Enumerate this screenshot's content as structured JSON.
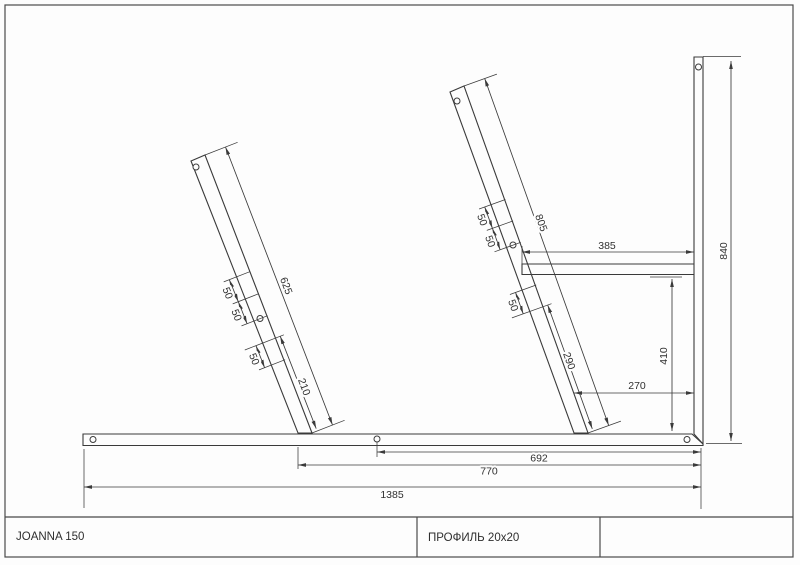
{
  "page": {
    "background": "#fdfdfd",
    "line_color": "#3a3a3a"
  },
  "title_block": {
    "model": "JOANNA 150",
    "profile": "ПРОФИЛЬ 20x20"
  },
  "dims": {
    "left_leg_total": "625",
    "left_leg_bottom": "210",
    "spacing": "50",
    "right_leg_total": "805",
    "right_leg_bottom": "290",
    "seat_rail": "385",
    "seat_height": "410",
    "leg_offset": "270",
    "back_height": "840",
    "hole_to_end": "692",
    "leg_to_end": "770",
    "base_total": "1385"
  }
}
